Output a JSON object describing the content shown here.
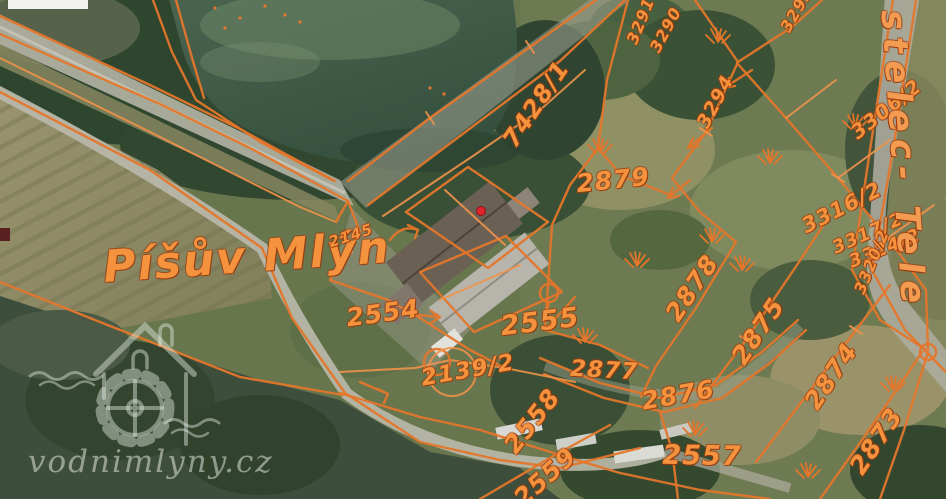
{
  "map": {
    "type": "aerial-cadastral-map",
    "place_name": "Píšův Mlýn",
    "overlay_color": "#e4762b",
    "label_color": "#f5923e",
    "watermark": {
      "text": "vodnimlyny.cz",
      "icon": "watermill-logo"
    },
    "marker": {
      "name": "mill-location-marker",
      "color": "#e0252b"
    },
    "labels": [
      {
        "text": "7428/1",
        "x": 536,
        "y": 104,
        "rot": -56,
        "size": 24
      },
      {
        "text": "2879",
        "x": 613,
        "y": 180,
        "rot": -6,
        "size": 25
      },
      {
        "text": "Píšův Mlýn",
        "x": 247,
        "y": 258,
        "rot": -4,
        "size": 44,
        "cls": "place"
      },
      {
        "text": "2145",
        "x": 351,
        "y": 236,
        "rot": -18,
        "size": 15
      },
      {
        "text": "2554",
        "x": 383,
        "y": 313,
        "rot": -8,
        "size": 25
      },
      {
        "text": "2555",
        "x": 540,
        "y": 322,
        "rot": -7,
        "size": 27
      },
      {
        "text": "2139/2",
        "x": 468,
        "y": 371,
        "rot": -10,
        "size": 23
      },
      {
        "text": "2558",
        "x": 532,
        "y": 421,
        "rot": -52,
        "size": 25
      },
      {
        "text": "2559",
        "x": 545,
        "y": 477,
        "rot": -42,
        "size": 25
      },
      {
        "text": "2877",
        "x": 604,
        "y": 371,
        "rot": 3,
        "size": 23
      },
      {
        "text": "2876",
        "x": 678,
        "y": 395,
        "rot": -10,
        "size": 25
      },
      {
        "text": "2557",
        "x": 702,
        "y": 456,
        "rot": 1,
        "size": 27
      },
      {
        "text": "2878",
        "x": 692,
        "y": 288,
        "rot": -56,
        "size": 25
      },
      {
        "text": "2875",
        "x": 758,
        "y": 331,
        "rot": -56,
        "size": 25
      },
      {
        "text": "2874",
        "x": 831,
        "y": 376,
        "rot": -56,
        "size": 25
      },
      {
        "text": "2873",
        "x": 876,
        "y": 441,
        "rot": -56,
        "size": 25
      },
      {
        "text": "3306/2",
        "x": 886,
        "y": 109,
        "rot": -38,
        "size": 20
      },
      {
        "text": "3316/2",
        "x": 842,
        "y": 208,
        "rot": -27,
        "size": 21
      },
      {
        "text": "3317/2",
        "x": 868,
        "y": 234,
        "rot": -24,
        "size": 18
      },
      {
        "text": "3324/2",
        "x": 885,
        "y": 249,
        "rot": -22,
        "size": 18
      },
      {
        "text": "3320/2",
        "x": 872,
        "y": 262,
        "rot": -68,
        "size": 16
      },
      {
        "text": "3294",
        "x": 716,
        "y": 102,
        "rot": -62,
        "size": 19
      },
      {
        "text": "3291",
        "x": 641,
        "y": 21,
        "rot": -68,
        "size": 16
      },
      {
        "text": "3290",
        "x": 666,
        "y": 30,
        "rot": -62,
        "size": 16
      },
      {
        "text": "3293",
        "x": 797,
        "y": 10,
        "rot": -60,
        "size": 16
      },
      {
        "text": "stelec- Tele",
        "x": 903,
        "y": 160,
        "rot": 86,
        "size": 34,
        "cls": "boundary"
      }
    ]
  }
}
